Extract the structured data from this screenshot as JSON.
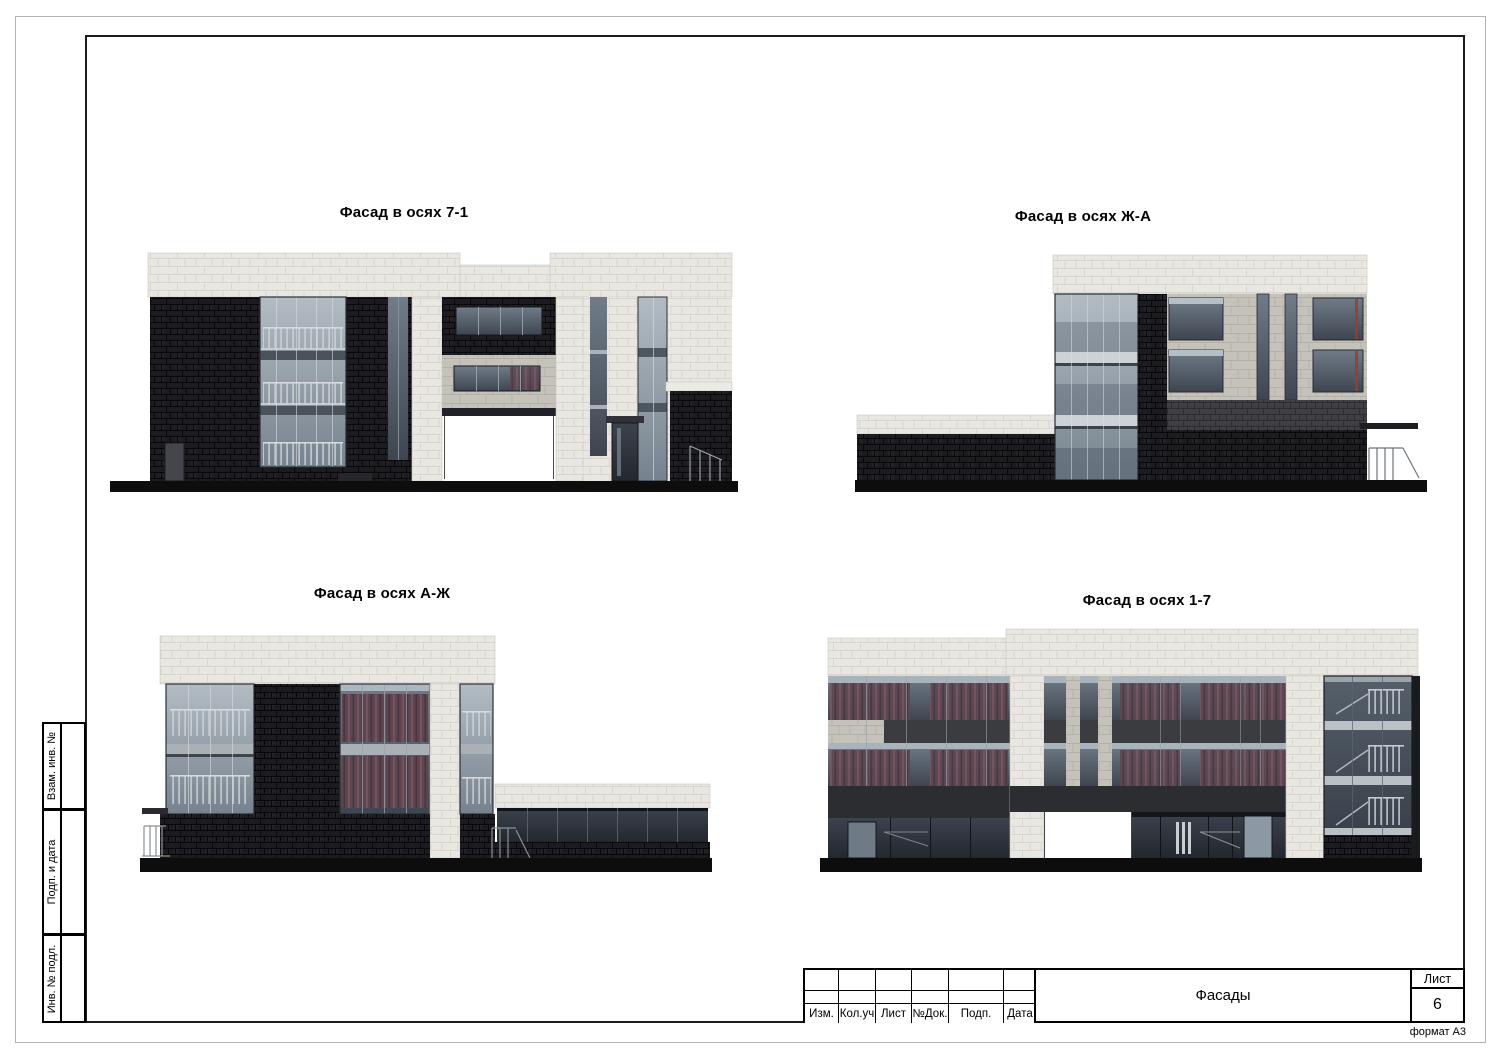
{
  "sheet": {
    "format_note": "формат А3",
    "drawings": [
      {
        "title": "Фасад в осях 7-1"
      },
      {
        "title": "Фасад в осях Ж-А"
      },
      {
        "title": "Фасад в осях А-Ж"
      },
      {
        "title": "Фасад в осях 1-7"
      }
    ],
    "title_block": {
      "columns": [
        "Изм.",
        "Кол.уч",
        "Лист",
        "№Док.",
        "Подп.",
        "Дата"
      ],
      "document_title": "Фасады",
      "sheet_label": "Лист",
      "sheet_number": "6"
    },
    "side_block": {
      "labels": [
        "Взам. инв. №",
        "Подп. и дата",
        "Инв. № подл."
      ]
    },
    "colors": {
      "page_edge": "#b3b3b3",
      "frame_line": "#1c1c1c",
      "parapet_tile": "#e9e7e1",
      "panel_beige": "#c5c2ba",
      "brick_black": "#1c1b1f",
      "brick_grey": "#403f43",
      "glass_light": "#b3bcc3",
      "glass_dark": "#3e4550",
      "curtain_red": "#5e4650",
      "ground": "#0d0d0d"
    }
  }
}
